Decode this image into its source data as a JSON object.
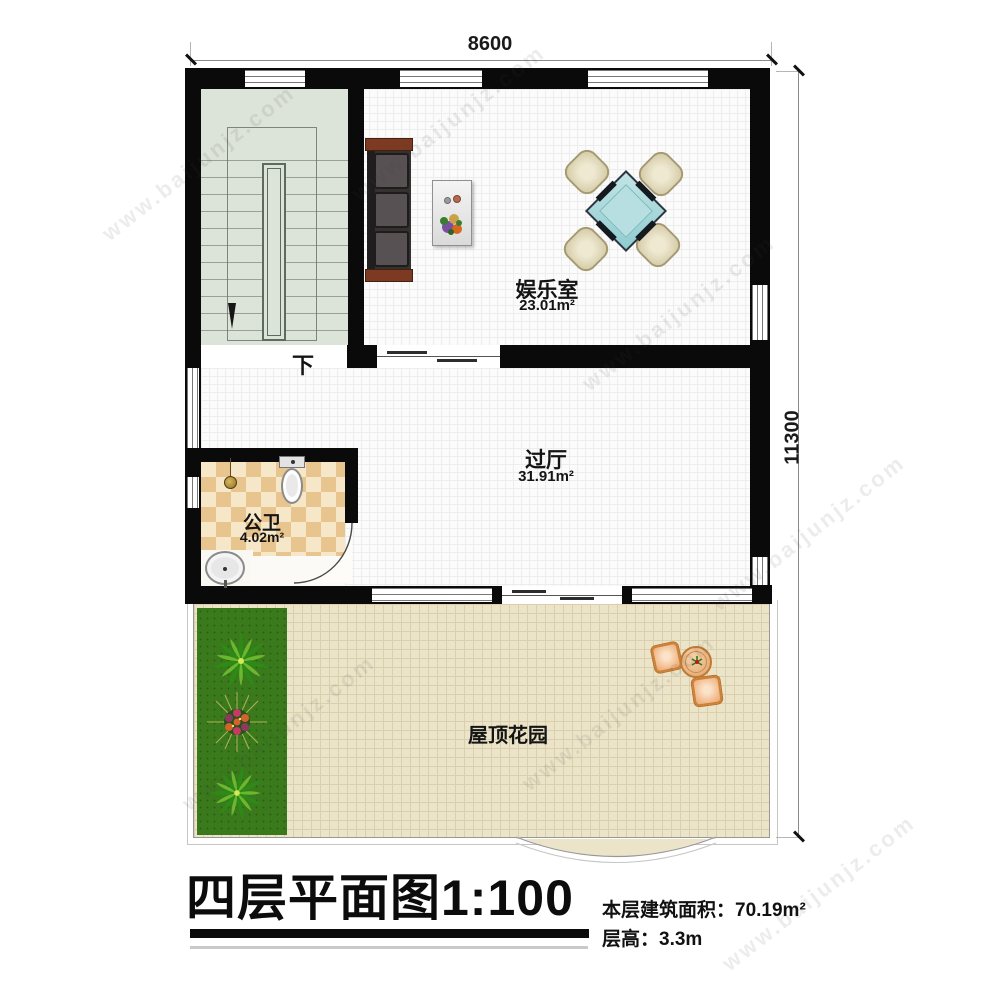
{
  "watermark": {
    "text": "www.baijunjz.com"
  },
  "dimensions": {
    "top": "8600",
    "right": "11300"
  },
  "rooms": [
    {
      "id": "entertainment-room",
      "name": "娱乐室",
      "area": "23.01m²"
    },
    {
      "id": "hall",
      "name": "过厅",
      "area": "31.91m²"
    },
    {
      "id": "bathroom",
      "name": "公卫",
      "area": "4.02m²"
    },
    {
      "id": "roof-garden",
      "name": "屋顶花园",
      "area": ""
    }
  ],
  "stairs": {
    "down_label": "下"
  },
  "title": {
    "text": "四层平面图1:100"
  },
  "info": {
    "area_line": "本层建筑面积：70.19m²",
    "height_line": "层高：3.3m"
  },
  "colors": {
    "wall": "#0a0a0a",
    "stair_floor": "#dce3d8",
    "garden_floor": "#ece4c9",
    "grass": "#3a7a1c",
    "mahjong_table": "#a9d8da",
    "bath_tile": "#e8c48e",
    "wood_trim": "#7c3a22"
  }
}
